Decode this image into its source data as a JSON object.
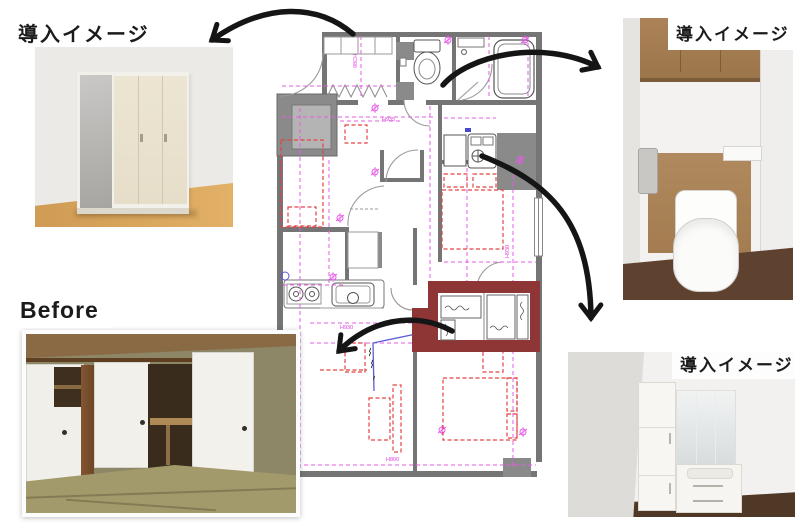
{
  "labels": {
    "top_left": "導入イメージ",
    "top_right": "導入イメージ",
    "bottom_right": "導入イメージ",
    "before": "Before"
  },
  "floor_plan": {
    "highlight_color": "#8e3535",
    "annotations": [
      {
        "text": "H935"
      },
      {
        "text": "98CH"
      },
      {
        "text": "H930"
      },
      {
        "text": "H800"
      },
      {
        "text": "H930"
      }
    ]
  },
  "colors": {
    "arrow": "#151515",
    "wall": "#757575",
    "wall_block": "#8a8a8a",
    "plan_magenta": "#e65ce6",
    "furniture_red": "#e34343",
    "utility_blue": "#5b5bd6",
    "highlight_box": "#8e3535"
  }
}
